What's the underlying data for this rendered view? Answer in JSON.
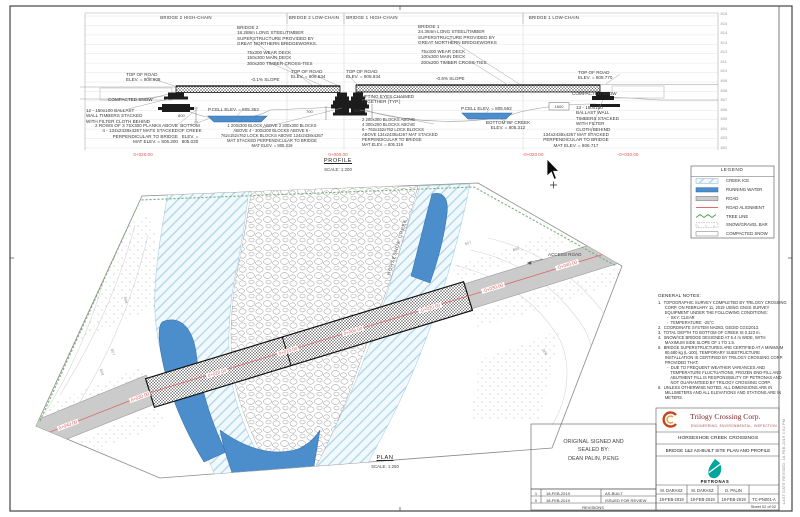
{
  "profile": {
    "title": "PROFILE",
    "scale": "SCALE:  1:200",
    "headers": [
      "BRIDGE 2  HIGH-CHAIN",
      "BRIDGE 2  LOW-CHAIN",
      "BRIDGE 1  HIGH-CHAIN",
      "BRIDGE 1  LOW-CHAIN"
    ],
    "elevations": [
      "816",
      "815",
      "814",
      "813",
      "812",
      "811",
      "810",
      "809",
      "808",
      "807",
      "806",
      "805",
      "804",
      "803",
      "802"
    ],
    "stations": [
      "0+020.00",
      "0+000.00",
      "-0+020.00",
      "-0+030.00"
    ],
    "dims": {
      "d800": "800",
      "d700": "700",
      "d900": "900",
      "d1600": "1600"
    },
    "ann": {
      "bridge2": "BRIDGE 2\n18.288m LONG STEEL/TIMBER\nSUPERSTRUCTURE PROVIDED BY\nGREAT NORTHERN BRIDGEWORKS.",
      "deck2": "75x300 WEAR DECK\n150x300 MAIN DECK\n300x200 TIMBER CROSS-TIES",
      "tor_608": "TOP OF ROAD\nELEV. = 808.608",
      "slope2": "-0.1% SLOPE",
      "tor_634a": "TOP OF ROAD\nELEV. = 808.634",
      "tor_634b": "TOP OF ROAD\nELEV. = 808.634",
      "snow_left": "COMPACTED SNOW",
      "ballast_left": "12 - 150x100 BALLAST\nWALL TIMBERS STACKED\nWITH FILTER CLOTH BEHIND",
      "pcell2": "P.CELL ELEV. = 805.353",
      "planks": "2 ROWS OF 3 75X300 PLANKS ABOVE\n4 - 134x2438x4267 MATS STACKED\nPERPENDICULAR TO BRIDGE\nMAT ELEV. = 806.200",
      "creek_bottom2": "BOTTOM\nOF CREEK\nELEV. =\n805.030",
      "blocks2": "1 200x300 BLOCK ABOVE 2 200x300 BLOCKS\nABOVE 4 - 300x200 BLOCKS ABOVE 6 -\n762x152x762 LOCK BLOCKS ABOVE 134x2438x4267\nMAT STACKED PERPENDICULAR TO BRIDGE\nMAT ELEV. = 805.319",
      "bridge1": "BRIDGE 1\n24.384m LONG STEEL/TIMBER\nSUPERSTRUCTURE PROVIDED BY\nGREAT NORTHERN BRIDGEWORKS",
      "deck1": "75x300 WEAR DECK\n100x300 MAIN DECK\n200x200 TIMBER CROSS-TIES",
      "slope1": "-0.6% SLOPE",
      "eyes": "LIFTING EYES CHAINED\nTOGETHER (TYP.)",
      "pcell1": "P.CELL ELEV. = 805.562",
      "creek_bottom1": "BOTTOM OF CREEK\nELEV. = 805.312",
      "blocks1": "2 200x300 BLOCKS ABOVE\n4 300x200 BLOCKS ABOVE\n6 - 762x152x762 LOCK BLOCKS\nABOVE 134x2438x4267 MAT STACKED\nPERPENDICULAR TO BRIDGE\nMAT ELEV. = 805.319",
      "ballast_right": "13 - 150x100\nBALLAST WALL\nTIMBERS STACKED\nWITH FILTER\nCLOTH BEHIND",
      "mat_right": "134x2438x4267 MAT STACKED\nPERPENDICULAR TO BRIDGE\nMAT ELEV. = 806.717",
      "tor_770": "TOP OF ROAD\nELEV. = 808.770",
      "snow_right": "COMPACTED SNOW"
    }
  },
  "legend": {
    "title": "LEGEND",
    "items": [
      {
        "label": "CREEK ICE",
        "swatch": "creek-ice-hatch",
        "color": "#a6d3ea"
      },
      {
        "label": "RUNNING WATER",
        "swatch": "solid-blue",
        "color": "#4c8ecb"
      },
      {
        "label": "ROAD",
        "swatch": "solid-gray",
        "color": "#cccccc"
      },
      {
        "label": "ROAD ALIGNMENT",
        "swatch": "red-line",
        "color": "#e05555"
      },
      {
        "label": "TREE LINE",
        "swatch": "green-zigzag",
        "color": "#3f9b3f"
      },
      {
        "label": "SNOW/GRAVEL BAR",
        "swatch": "dotted",
        "color": "#9a9a9a"
      },
      {
        "label": "COMPACTED SNOW",
        "swatch": "white",
        "color": "#ffffff"
      }
    ]
  },
  "general_notes": {
    "heading": "GENERAL NOTES:",
    "body": "1.  TOPOGRAPHIC SURVEY COMPLETED BY TRILOGY CROSSING\n      CORP. ON FEBRUARY 11, 2019 USING GNSS SURVEY\n      EQUIPMENT UNDER THE FOLLOWING CONDITIONS:\n        -  SKY: CLEAR\n        -  TEMPERATURE: -25°C\n2.  COORDINATE SYSTEM NAD83, GEOID CGG2013.\n3.  TOTAL DEPTH TO BOTTOM OF CREEK IS 0.323 m.\n4.  SNOW/ICE BRIDGE DESIGNED AT 5.4 m WIDE, WITH\n      MAXIMUM SIDE SLOPE OF 1 TO 1.5.\n5.  BRIDGE SUPERSTRUCTURES ARE CERTIFIED AT A MINIMUM\n      80,680 kg (L-100). TEMPORARY SUBSTRUCTURE\n      INSTALLATION IS CERTIFIED BY TRILOGY CROSSING CORP.\n      PROVIDED THAT:\n        -  DUE TO FREQUENT WEATHER VARIANCES AND\n           TEMPERATURE FLUCTUATIONS, FROZEN END-FILL AND\n           ABUTMENT FILL IS RESPONSIBILITY OF PETRONAS AND\n           NOT GUARANTEED BY TRILOGY CROSSING CORP.\n6.  UNLESS OTHERWISE NOTED, ALL DIMENSIONS ARE IN\n      MILLIMETERS AND ALL ELEVATIONS AND STATIONS ARE IN\n      METERS."
  },
  "plan": {
    "title": "PLAN",
    "scale": "SCALE:  1:250",
    "creek_label": "HORSESHOE CREEK",
    "road_label": "ACCESS ROAD",
    "stations": [
      "0+040.00",
      "0+030.00",
      "0+020.00",
      "0+010.00",
      "0+000.00",
      "-0+020.00",
      "-0+030.00",
      "-0+040.00"
    ],
    "contours": [
      "807",
      "808",
      "806",
      "807",
      "808",
      "806"
    ]
  },
  "signature": {
    "text": "ORIGINAL SIGNED AND\nSEALED BY:\nDEAN PALIN, P.ENG"
  },
  "revisions": {
    "rows": [
      {
        "rev": "1",
        "date": "18-FEB-2019",
        "desc": "AS-BUILT"
      },
      {
        "rev": "0",
        "date": "18-FEB-2019",
        "desc": "ISSUED FOR REVIEW"
      }
    ],
    "footer": "REVISIONS"
  },
  "title_block": {
    "company": "Trilogy Crossing Corp.",
    "tagline": "ENGINEERING, ENVIRONMENTAL, INSPECTION",
    "project": "HORSESHOE CREEK CROSSINGS",
    "sheet_title": "BRIDGE 1&2 AS-BUILT SITE PLAN AND PROFILE",
    "client": "PETRONAS",
    "names": [
      "M. DARASZ",
      "M. DARASZ",
      "D. PALIN"
    ],
    "dates": [
      "18-FEB-2019",
      "18-FEB-2019",
      "18-FEB-2019"
    ],
    "doc_no": "TC-PN001-A",
    "sheet": "Sheet  02  of  02"
  },
  "frame": {
    "edge_note": "LAST DATE REVISED: 18-FEB-2019  3:52 PM"
  }
}
